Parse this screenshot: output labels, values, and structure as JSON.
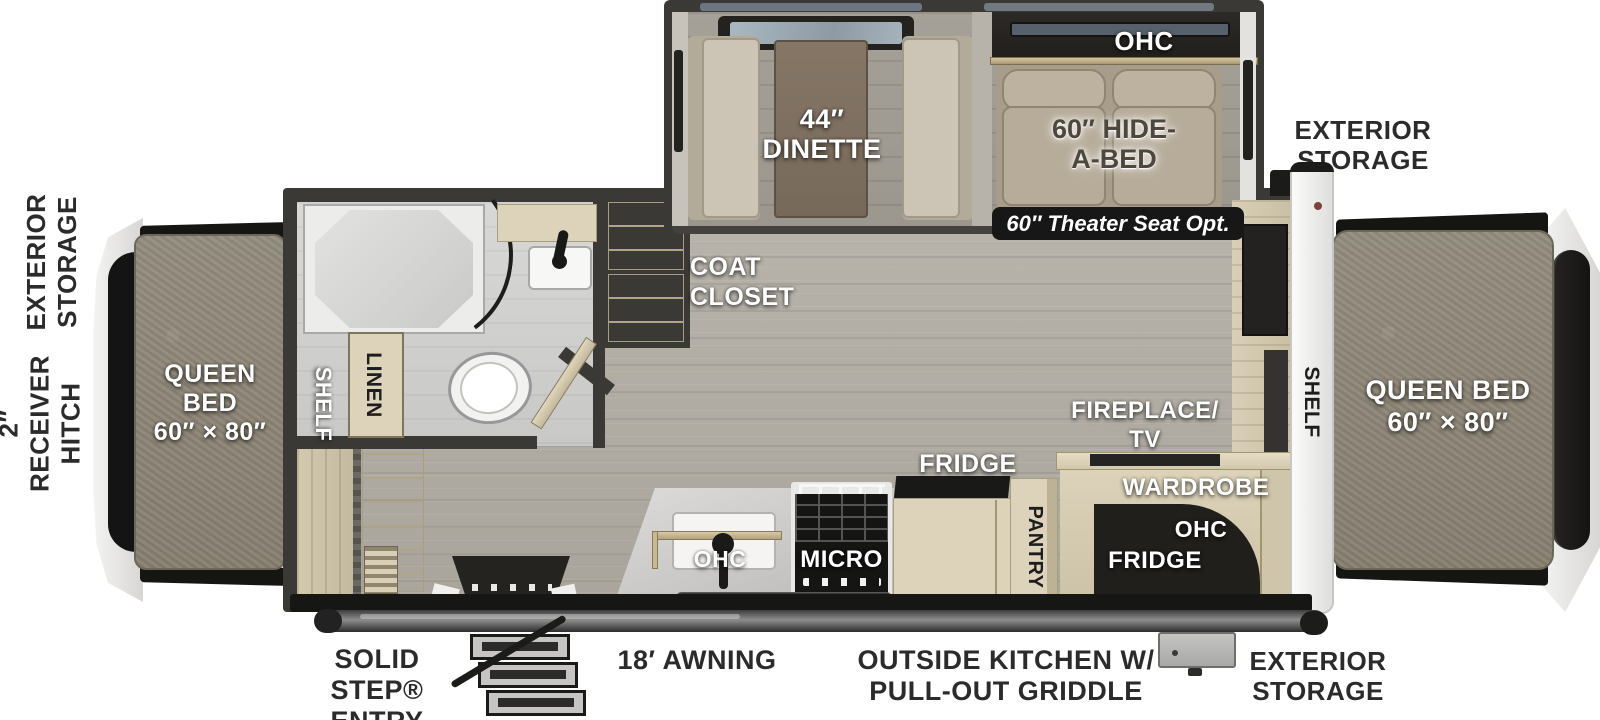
{
  "title": "travel-trailer-floorplan",
  "palette": {
    "wall": "#3b3936",
    "floor": "#b0aca3",
    "cream_cabinet": "#ddd3bb",
    "mattress": "#8e8778",
    "label_dark": "#2b2b2b",
    "badge_bg": "#171717",
    "exterior_white": "#f4f4f2",
    "appliance_black": "#171717"
  },
  "front": {
    "storage_line1": "EXTERIOR",
    "storage_line2": "STORAGE",
    "hitch_line1": "2″",
    "hitch_line2": "RECEIVER",
    "hitch_line3": "HITCH",
    "bed_line1": "QUEEN",
    "bed_line2": "BED",
    "bed_line3": "60″ × 80″",
    "shelf": "SHELF"
  },
  "slideout": {
    "dinette_line1": "44″",
    "dinette_line2": "DINETTE",
    "ohc": "OHC",
    "hide_a_bed_line1": "60″ HIDE-",
    "hide_a_bed_line2": "A-BED",
    "theater_badge": "60″ Theater Seat Opt."
  },
  "bathroom": {
    "linen": "LINEN"
  },
  "living": {
    "coat_closet_line1": "COAT",
    "coat_closet_line2": "CLOSET",
    "fireplace_line1": "FIREPLACE/",
    "fireplace_line2": "TV"
  },
  "kitchen": {
    "ohc": "OHC",
    "micro": "MICRO",
    "fridge": "FRIDGE",
    "pantry": "PANTRY"
  },
  "bedroom": {
    "wardrobe": "WARDROBE",
    "ohc": "OHC",
    "fridge": "FRIDGE",
    "shelf": "SHELF",
    "bed_line1": "QUEEN BED",
    "bed_line2": "60″ × 80″",
    "storage_line1": "EXTERIOR",
    "storage_line2": "STORAGE"
  },
  "exterior_bottom": {
    "solid_step_line1": "SOLID STEP®",
    "solid_step_line2": "ENTRY",
    "awning": "18′ AWNING",
    "outside_kitchen_line1": "OUTSIDE KITCHEN W/",
    "outside_kitchen_line2": "PULL-OUT GRIDDLE",
    "storage_line1": "EXTERIOR",
    "storage_line2": "STORAGE"
  }
}
